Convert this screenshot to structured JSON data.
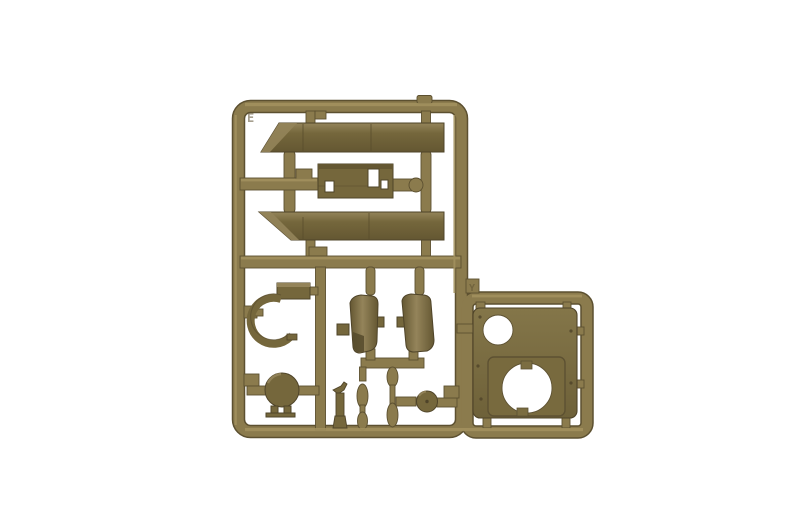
{
  "scene": {
    "subject": "Injection-molded plastic model kit sprue (parts tree) in olive drab plastic, photographed on a white background",
    "background_color": "#ffffff",
    "markings": {
      "corner_letter": "E",
      "gate_letter": "Y"
    },
    "colors": {
      "runner_base": "#8b7b4d",
      "runner_light": "#a3925f",
      "runner_dark": "#5c5030",
      "part_light": "#94845a",
      "part_base": "#75673c",
      "part_deep": "#645732",
      "part_outline": "#4f4429",
      "plate_light": "#847649",
      "plate_base": "#7b6d41",
      "plate_deep": "#6e6139",
      "hole_white": "#ffffff",
      "emboss": "#5e5233"
    },
    "parts": [
      {
        "name": "fender-strip-upper",
        "description": "Long fender/side-skirt strip, angled pointed left end (tip at bottom)"
      },
      {
        "name": "fender-strip-lower",
        "description": "Long fender/side-skirt strip, angled pointed left end (tip at top)"
      },
      {
        "name": "slotted-plate",
        "description": "Small rectangular plate with three rectangular cutouts"
      },
      {
        "name": "fender-arch",
        "description": "C-shaped curved arch with rectangular mounting block"
      },
      {
        "name": "curved-shell-left",
        "description": "Curved shell/cowling half with side tabs and notched lower corner"
      },
      {
        "name": "curved-shell-right",
        "description": "Curved shell/cowling half with side tab"
      },
      {
        "name": "round-hatch",
        "description": "Circular hatch disc with hinge tabs below"
      },
      {
        "name": "small-bracket",
        "description": "Small hook-shaped bracket standing on the bottom runner"
      },
      {
        "name": "small-wheel",
        "description": "Small round wheel/cap with centre axle hole"
      },
      {
        "name": "hull-plate",
        "description": "Square hull/turret plate with one small and one large circular opening in a recessed panel"
      }
    ]
  }
}
